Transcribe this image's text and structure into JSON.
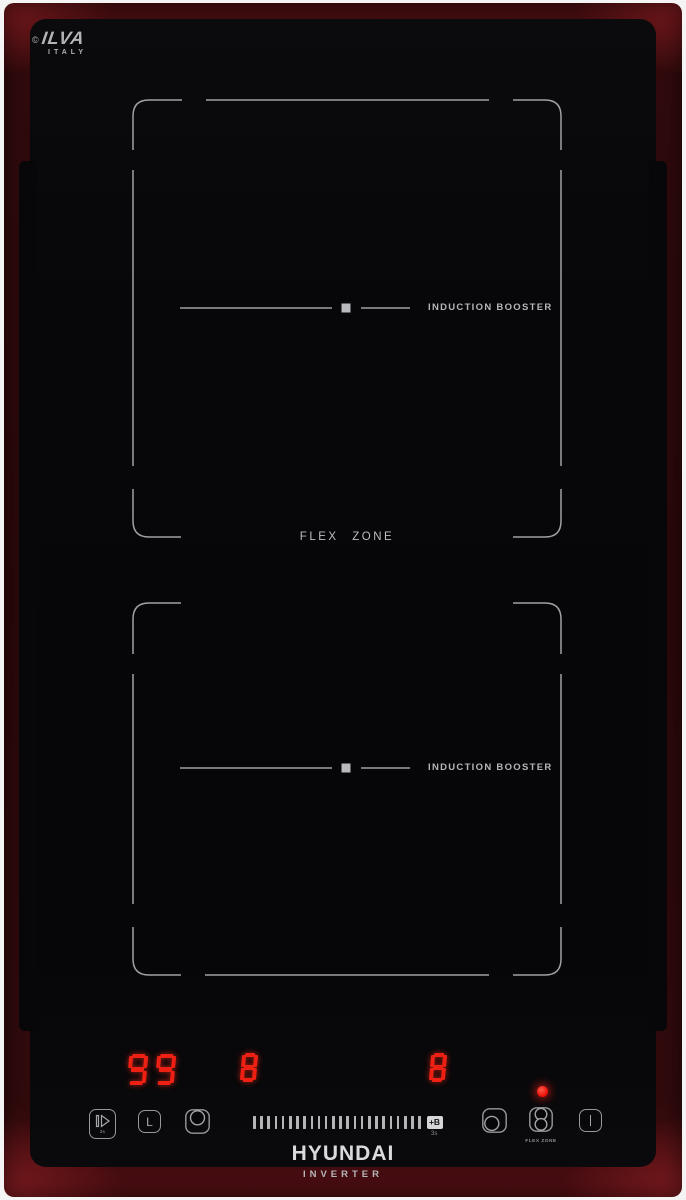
{
  "branding": {
    "glass_logo_mark": "©",
    "glass_logo": "ILVA",
    "glass_logo_country": "ITALY",
    "brand_name": "HYUNDAI",
    "brand_subtitle": "INVERTER"
  },
  "surface": {
    "flex_zone_label": "FLEX  ZONE",
    "zone_top_label": "INDUCTION BOOSTER",
    "zone_bottom_label": "INDUCTION BOOSTER"
  },
  "controls": {
    "displays": {
      "timer": "99",
      "zone_left": "8",
      "zone_right": "8"
    },
    "buttons": {
      "pause_sub": "3s",
      "lock_glyph": "L",
      "boost_label": "+B",
      "boost_sub": "3s",
      "flex_label": "FLEX ZONE"
    },
    "slider_ticks": 24,
    "led_on": true
  },
  "colors": {
    "display_red": "#ee2014",
    "led_red": "#ff170d",
    "outline_gray": "#9fa1a4",
    "frame_red": "#300a0c"
  }
}
